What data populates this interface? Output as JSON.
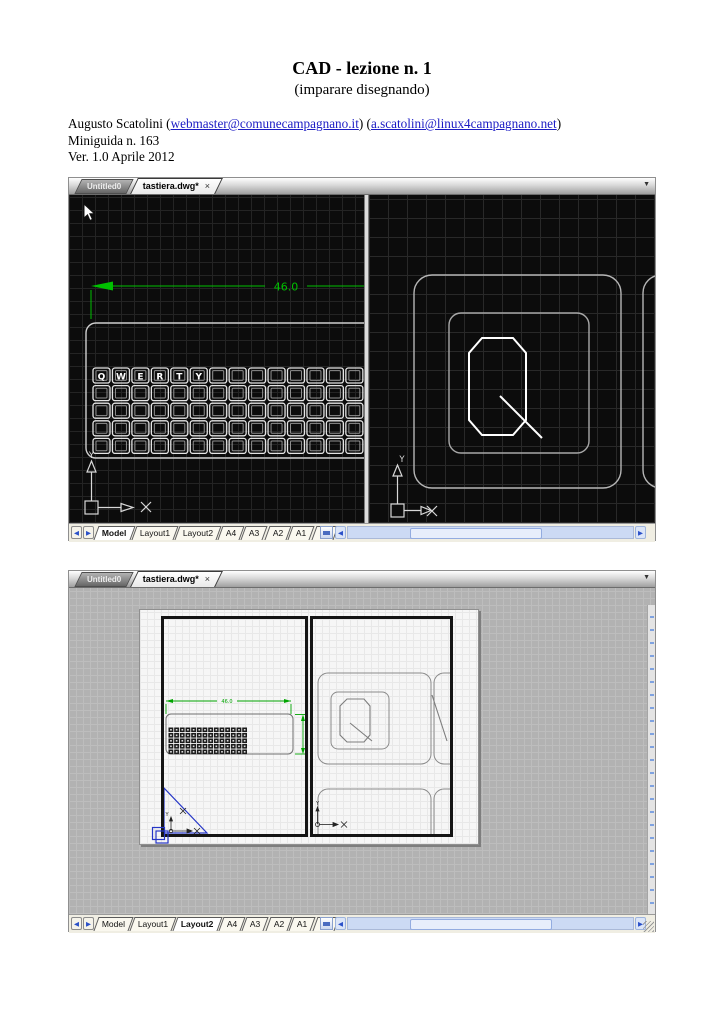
{
  "doc": {
    "title": "CAD - lezione n. 1",
    "subtitle": "(imparare disegnando)",
    "author_prefix": "Augusto Scatolini (",
    "email1": "webmaster@comunecampagnano.it",
    "between": ") (",
    "email2": "a.scatolini@linux4campagnano.net",
    "author_suffix": ")",
    "miniguida": "Miniguida n. 163",
    "version": "Ver. 1.0 Aprile 2012"
  },
  "colors": {
    "link_blue": "#1c1cc4",
    "dimension_green": "#00c000",
    "ucs_blue": "#2636c6",
    "model_background": "#0c0c0c",
    "layout_background": "#b2b2b2"
  },
  "cad1": {
    "doc_tabs": {
      "inactive": "Untitled0",
      "active": "tastiera.dwg*",
      "close": "×",
      "menu": "▼"
    },
    "drawing": {
      "dimension": "46.0",
      "key_letters": [
        "Q",
        "W",
        "E",
        "R",
        "T",
        "Y"
      ],
      "y_label_left": "Y",
      "y_label_right": "Y"
    },
    "layout_tabs": [
      "Model",
      "Layout1",
      "Layout2",
      "A4",
      "A3",
      "A2",
      "A1",
      "A0"
    ],
    "active_layout": "Model",
    "nav": {
      "prev": "◀",
      "next": "▶"
    },
    "scrollbar": {
      "left": "◀",
      "right": "▶"
    }
  },
  "cad2": {
    "doc_tabs": {
      "inactive": "Untitled0",
      "active": "tastiera.dwg*",
      "close": "×",
      "menu": "▼"
    },
    "drawing": {
      "dimension": "46.0",
      "y_label_left": "Y",
      "y_label_right": "Y"
    },
    "layout_tabs": [
      "Model",
      "Layout1",
      "Layout2",
      "A4",
      "A3",
      "A2",
      "A1",
      "A0"
    ],
    "active_layout": "Layout2",
    "nav": {
      "prev": "◀",
      "next": "▶"
    },
    "scrollbar": {
      "left": "◀",
      "right": "▶"
    }
  }
}
